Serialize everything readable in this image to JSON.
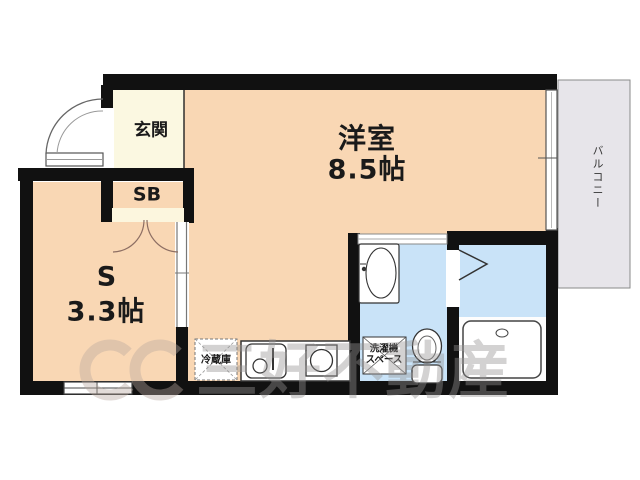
{
  "floorplan": {
    "rooms": {
      "genkan": {
        "label": "玄関"
      },
      "shoe_box": {
        "label": "SB"
      },
      "western": {
        "label": "洋室",
        "size": "8.5帖"
      },
      "service": {
        "label": "S",
        "size": "3.3帖"
      },
      "balcony": {
        "label": "バルコニー"
      }
    },
    "fixtures": {
      "refrigerator": {
        "label": "冷蔵庫"
      },
      "washer_space": {
        "line1": "洗濯機",
        "line2": "スペース"
      }
    },
    "watermark": {
      "text": "三好不動産"
    },
    "colors": {
      "wall": "#111111",
      "room_floor": "#F9D7B4",
      "genkan_floor": "#FBF8E1",
      "shoe_box_fill": "#F5CF58",
      "wet_area": "#C9E3F8",
      "balcony_fill": "#E7E5EA"
    }
  }
}
